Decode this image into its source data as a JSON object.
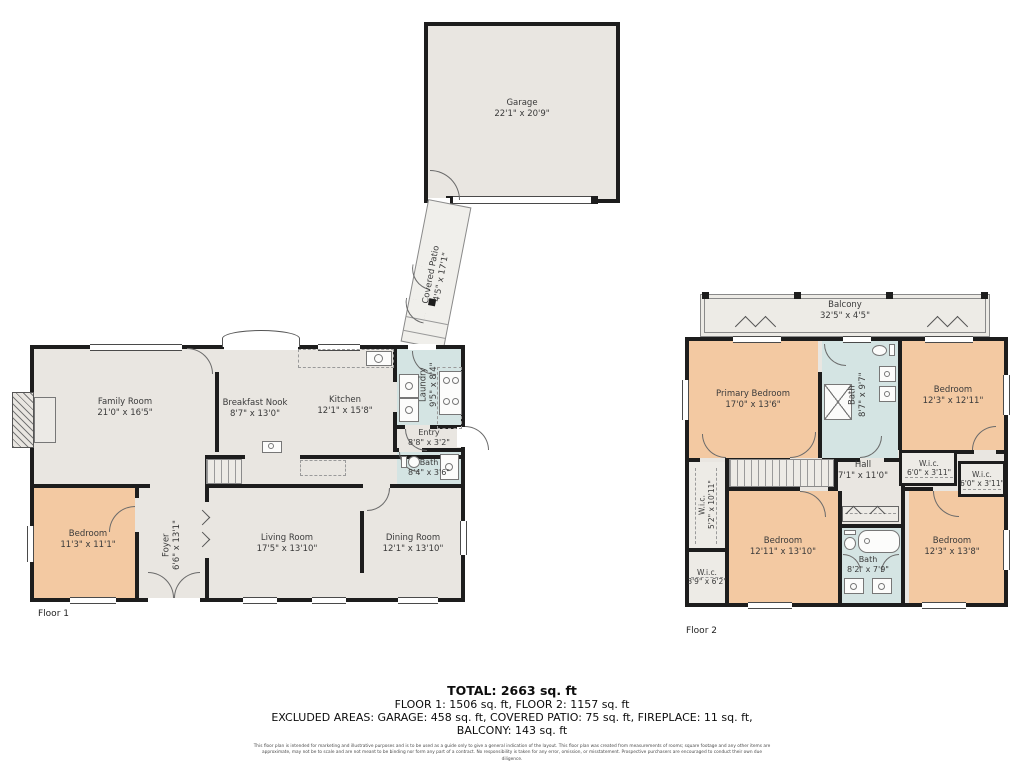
{
  "colors": {
    "wall": "#1d1d1d",
    "floor": "#e9e6e1",
    "bedroom": "#f3c9a2",
    "bath": "#d4e4e3",
    "outdoor": "#edebe6"
  },
  "garage": {
    "name": "Garage",
    "dims": "22'1\" x 20'9\""
  },
  "covered_patio": {
    "name": "Covered Patio",
    "dims": "4'5\" x 17'1\""
  },
  "floor1": {
    "label": "Floor 1",
    "rooms": {
      "family": {
        "name": "Family Room",
        "dims": "21'0\" x 16'5\""
      },
      "breakfast": {
        "name": "Breakfast Nook",
        "dims": "8'7\" x 13'0\""
      },
      "kitchen": {
        "name": "Kitchen",
        "dims": "12'1\" x 15'8\""
      },
      "laundry": {
        "name": "Laundry",
        "dims": "9'5\" x 8'4\""
      },
      "entry": {
        "name": "Entry",
        "dims": "8'8\" x 3'2\""
      },
      "bath": {
        "name": "Bath",
        "dims": "8'4\" x 3'6\""
      },
      "bedroom": {
        "name": "Bedroom",
        "dims": "11'3\" x 11'1\""
      },
      "foyer": {
        "name": "Foyer",
        "dims": "6'6\" x 13'1\""
      },
      "living": {
        "name": "Living Room",
        "dims": "17'5\" x 13'10\""
      },
      "dining": {
        "name": "Dining Room",
        "dims": "12'1\" x 13'10\""
      }
    }
  },
  "floor2": {
    "label": "Floor 2",
    "rooms": {
      "balcony": {
        "name": "Balcony",
        "dims": "32'5\" x 4'5\""
      },
      "primary": {
        "name": "Primary Bedroom",
        "dims": "17'0\" x 13'6\""
      },
      "bath_top": {
        "name": "Bath",
        "dims": "8'7\" x 9'7\""
      },
      "bedroom_tr": {
        "name": "Bedroom",
        "dims": "12'3\" x 12'11\""
      },
      "hall": {
        "name": "Hall",
        "dims": "7'1\" x 11'0\""
      },
      "wic_r1": {
        "name": "W.i.c.",
        "dims": "6'0\" x 3'11\""
      },
      "wic_r2": {
        "name": "W.i.c.",
        "dims": "6'0\" x 3'11\""
      },
      "wic_left": {
        "name": "W.i.c.",
        "dims": "5'2\" x 10'11\""
      },
      "wic_small": {
        "name": "W.i.c.",
        "dims": "3'9\" x 6'2\""
      },
      "bedroom_bl": {
        "name": "Bedroom",
        "dims": "12'11\" x 13'10\""
      },
      "bath_bottom": {
        "name": "Bath",
        "dims": "8'2\" x 7'9\""
      },
      "bedroom_br": {
        "name": "Bedroom",
        "dims": "12'3\" x 13'8\""
      }
    }
  },
  "summary": {
    "total": "TOTAL: 2663 sq. ft",
    "floors": "FLOOR 1: 1506 sq. ft, FLOOR 2: 1157 sq. ft",
    "excluded": "EXCLUDED AREAS: GARAGE: 458 sq. ft, COVERED PATIO: 75 sq. ft, FIREPLACE: 11 sq. ft,",
    "excluded2": "BALCONY: 143 sq. ft"
  },
  "disclaimer": "This floor plan is intended for marketing and illustrative purposes and is to be used as a guide only to give a general indication of the layout. This floor plan was created from measurements of rooms; square footage and any other items are approximate, may not be to scale and are not meant to be binding nor form any part of a contract. No responsibility is taken for any error, omission, or misstatement. Prospective purchasers are encouraged to conduct their own due diligence."
}
